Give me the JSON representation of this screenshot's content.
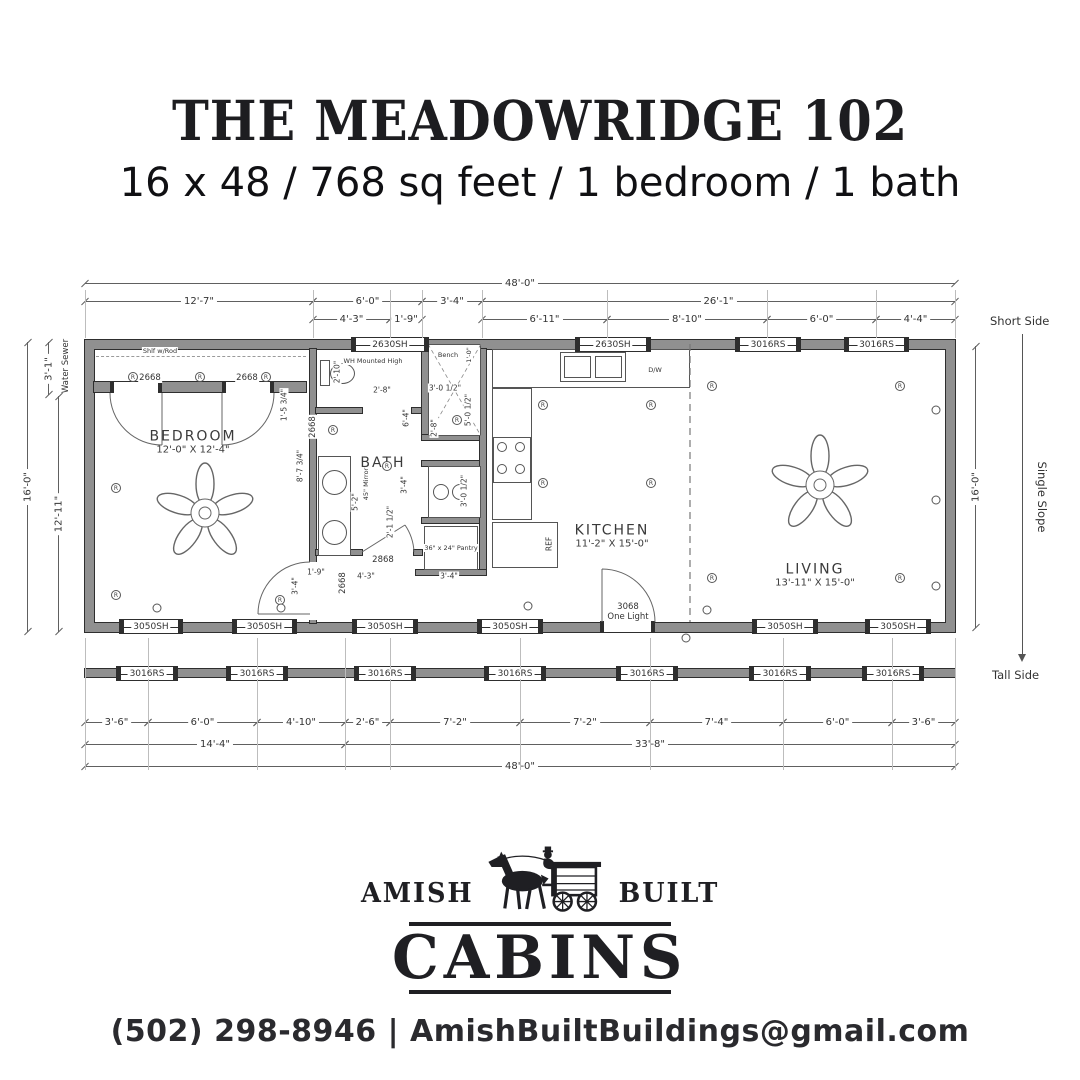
{
  "header": {
    "title": "THE MEADOWRIDGE 102",
    "subtitle": "16 x 48 / 768 sq feet / 1 bedroom / 1 bath"
  },
  "plan": {
    "dims": {
      "top_overall": "48'-0\"",
      "top_row1": [
        "12'-7\"",
        "6'-0\"",
        "3'-4\"",
        "26'-1\""
      ],
      "top_row2": [
        "4'-3\"",
        "1'-9\"",
        "6'-11\"",
        "8'-10\"",
        "6'-0\"",
        "4'-4\""
      ],
      "bottom_row1": [
        "3'-6\"",
        "6'-0\"",
        "4'-10\"",
        "2'-6\"",
        "7'-2\"",
        "7'-2\"",
        "7'-4\"",
        "6'-0\"",
        "3'-6\""
      ],
      "bottom_row2": [
        "14'-4\"",
        "33'-8\""
      ],
      "bottom_overall": "48'-0\"",
      "left_offset": "3'-1\"",
      "left_height": "16'-0\"",
      "left_inner": "12'-11\"",
      "right_height": "16'-0\""
    },
    "side_labels": {
      "short": "Short Side",
      "slope": "Single Slope",
      "tall": "Tall Side"
    },
    "utility_label": "Water Sewer",
    "rooms": {
      "bedroom": {
        "name": "BEDROOM",
        "size": "12'-0\" X 12'-4\""
      },
      "bath": {
        "name": "BATH"
      },
      "kitchen": {
        "name": "KITCHEN",
        "size": "11'-2\" X 15'-0\""
      },
      "living": {
        "name": "LIVING",
        "size": "13'-11\" X 15'-0\""
      }
    },
    "windows": {
      "top": [
        "2630SH",
        "2630SH",
        "3016RS",
        "3016RS"
      ],
      "bottom": [
        "3050SH",
        "3050SH",
        "3050SH",
        "3050SH",
        "3050SH",
        "3050SH"
      ],
      "porch": [
        "3016RS",
        "3016RS",
        "3016RS",
        "3016RS",
        "3016RS",
        "3016RS",
        "3016RS"
      ]
    },
    "doors": {
      "closet_left": "2668",
      "closet_right": "2668",
      "bedroom": "2668",
      "bath": "2868",
      "bath_side": "2668",
      "front_line1": "3068",
      "front_line2": "One Light"
    },
    "notes": {
      "closet_shelf": "Shlf w/Rod",
      "water_heater": "WH Mounted High",
      "bench": "Bench",
      "pantry": "36\" x 24\" Pantry",
      "mirror": "45\" Mirror",
      "dishwasher": "D/W",
      "refrigerator": "REF"
    },
    "inner_dims": {
      "toilet": "2'-10\"",
      "bench_depth": "1'-0\"",
      "hall": "2'-8\"",
      "shower_w": "3'-0 1/2\"",
      "shower_h": "5'-0 1/2\"",
      "shower_d": "2'-8\"",
      "bath_len": "6'-4\"",
      "bath_w": "3'-4\"",
      "vanity": "5'-2\"",
      "clearance": "2'-1 1/2\"",
      "wall_a": "8'-7 3/4\"",
      "wall_b": "1'-5 3/4\"",
      "laundry": "3'-0 1/2\"",
      "entry_a": "1'-9\"",
      "entry_b": "4'-3\"",
      "entry_c": "3'-4\"",
      "corner": "3'-4\""
    },
    "symbols": {
      "receptacle": "R"
    }
  },
  "logo": {
    "amish": "AMISH",
    "built": "BUILT",
    "cabins": "CABINS"
  },
  "footer": {
    "contact": "(502) 298-8946 | AmishBuiltBuildings@gmail.com"
  }
}
